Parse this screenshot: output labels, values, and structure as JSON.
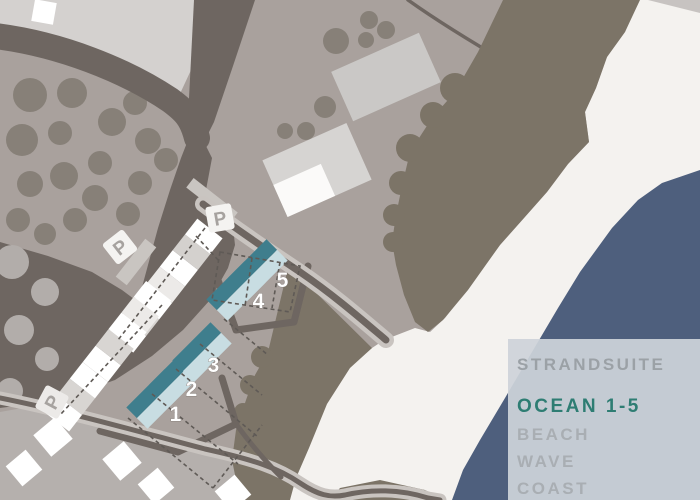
{
  "legend": {
    "items": [
      {
        "label": "STRANDSUITE",
        "color": "#9ba1a6"
      },
      {
        "label": "OCEAN 1-5",
        "color": "#2e7d73"
      },
      {
        "label": "BEACH",
        "color": "#a9aeb3"
      },
      {
        "label": "WAVE",
        "color": "#a9aeb3"
      },
      {
        "label": "COAST",
        "color": "#a9aeb3"
      }
    ]
  },
  "map": {
    "building_markers": [
      {
        "label": "1"
      },
      {
        "label": "2"
      },
      {
        "label": "3"
      },
      {
        "label": "4"
      },
      {
        "label": "5"
      }
    ],
    "parking_signs": [
      {
        "label": "P"
      },
      {
        "label": "P"
      },
      {
        "label": "P"
      }
    ],
    "colors": {
      "field": "#a9a19d",
      "field_light_top": "#d4d1cf",
      "field_light_bottom": "#b5b0ad",
      "road": "#6e6661",
      "dune": "#7c7467",
      "beach": "#f4f2ef",
      "ocean": "#4e5f7d",
      "tree": "#878078",
      "tree_light": "#b2adaa",
      "unit_dark_teal": "#3f7e8d",
      "unit_light_blue": "#c8dde2",
      "legend_box": "#cdd3d9"
    }
  }
}
